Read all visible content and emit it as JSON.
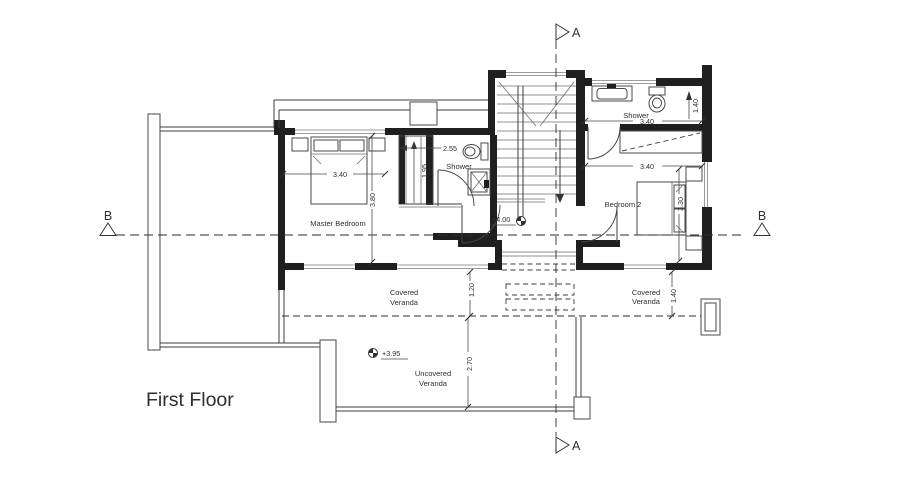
{
  "title": {
    "text": "First Floor"
  },
  "colors": {
    "title": "#e01f1f"
  },
  "section_markers": {
    "a": "A",
    "b": "B"
  },
  "room_labels": {
    "master_bedroom": "Master Bedroom",
    "bedroom_2": "Bedroom 2",
    "shower_middle": "Shower",
    "shower_top": "Shower",
    "covered_veranda_left": {
      "line1": "Covered",
      "line2": "Veranda"
    },
    "covered_veranda_right": {
      "line1": "Covered",
      "line2": "Veranda"
    },
    "uncovered_veranda": {
      "line1": "Uncovered",
      "line2": "Veranda"
    }
  },
  "level_markers": {
    "hall": "+4.00",
    "uncovered_veranda": "+3.95"
  },
  "dimensions": {
    "master_bedroom_width": "3.40",
    "master_bedroom_depth": "3.80",
    "closet_depth": "1.95",
    "closet_width": "2.55",
    "shower_top_width": "3.40",
    "shower_top_recess": "1.40",
    "bedroom_2_width": "3.40",
    "bedroom_2_depth": "3.30",
    "covered_veranda_left_depth": "1.20",
    "covered_veranda_right_depth": "1.40",
    "uncovered_veranda_depth": "2.70"
  }
}
